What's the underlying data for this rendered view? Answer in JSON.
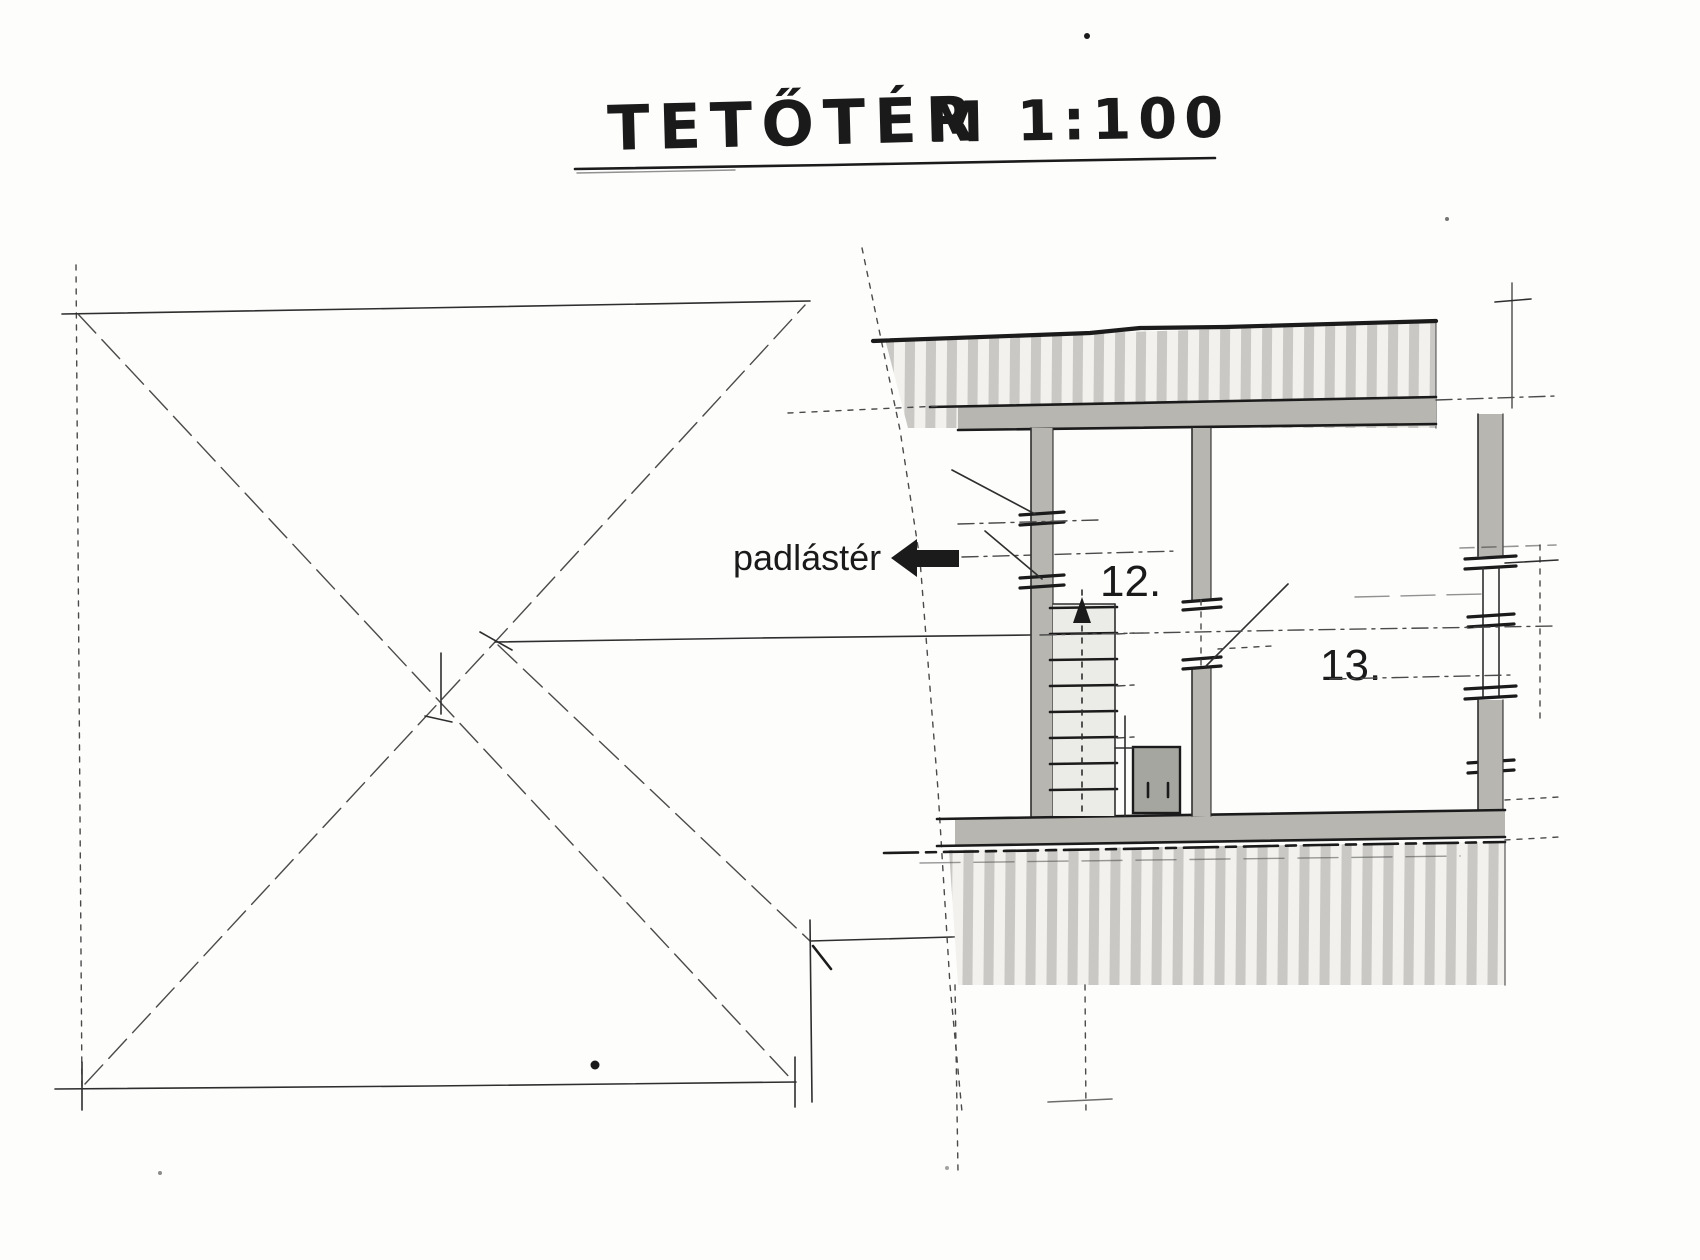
{
  "drawing": {
    "title": "TETŐTÉR",
    "scale": "M 1:100",
    "annotation": "padlástér",
    "rooms": [
      {
        "number": "12."
      },
      {
        "number": "13."
      }
    ],
    "colors": {
      "paper": "#fdfdfc",
      "ink": "#1b1b1b",
      "pencil": "#4a4a4a",
      "wall_fill": "#b7b6b1",
      "roof_stripe": "#c9c8c4",
      "roof_bg": "#f2f1ed",
      "stair_fill": "#ebebe7",
      "closet_fill": "#a6a6a1",
      "label": "#1a1a1a"
    }
  }
}
